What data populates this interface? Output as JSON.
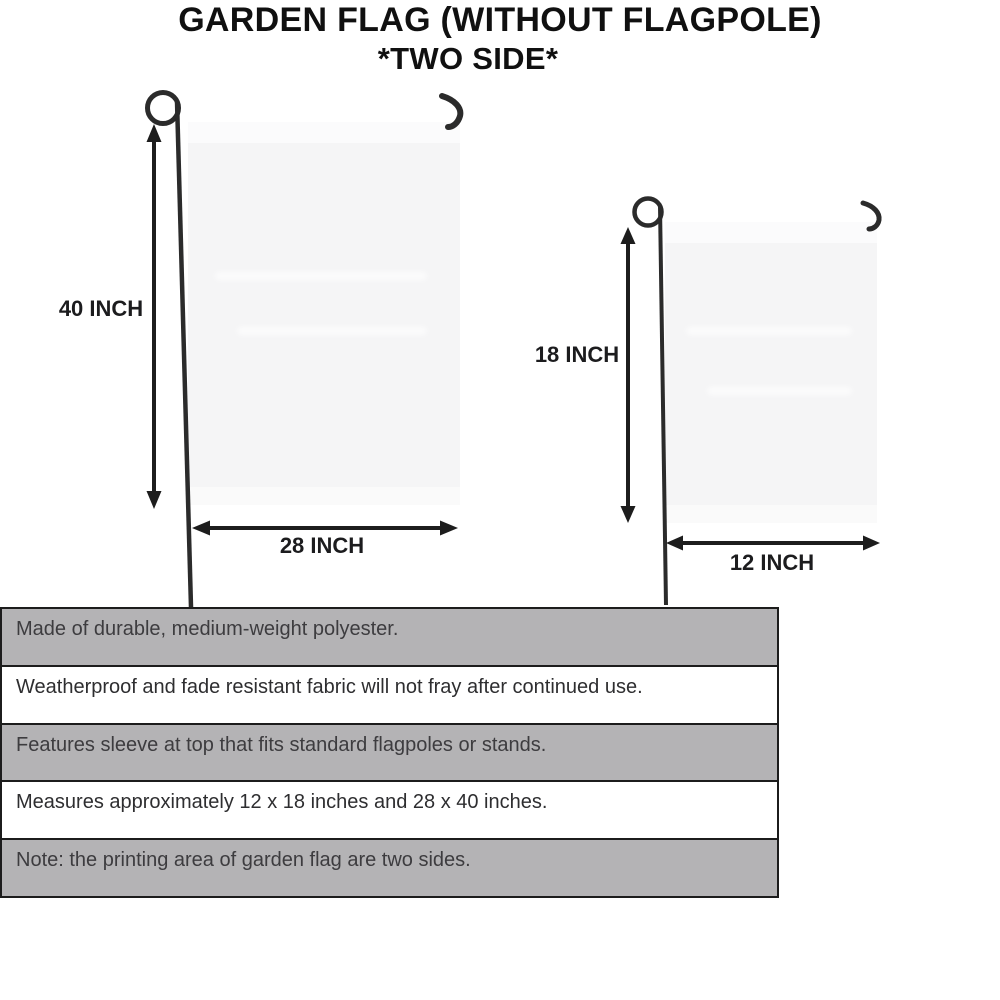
{
  "title": {
    "line1": "GARDEN FLAG (WITHOUT FLAGPOLE)",
    "line2": "*TWO SIDE*"
  },
  "diagram": {
    "large_flag": {
      "height_label": "40 INCH",
      "width_label": "28 INCH"
    },
    "small_flag": {
      "height_label": "18 INCH",
      "width_label": "12 INCH"
    }
  },
  "features": [
    {
      "text": "Made of durable, medium-weight polyester."
    },
    {
      "text": "Weatherproof and fade resistant fabric will not fray after continued use."
    },
    {
      "text": "Features sleeve at top that fits standard flagpoles or stands."
    },
    {
      "text": "Measures approximately 12 x 18 inches and 28 x 40 inches."
    },
    {
      "text": "Note: the printing area of garden flag are two sides."
    }
  ],
  "colors": {
    "ink": "#101010",
    "pole": "#2b2b2b",
    "arrow": "#1d1d1d",
    "flag_fill": "#f5f5f6",
    "row_gray": "#b4b3b5",
    "row_border": "#1c1c1c"
  }
}
